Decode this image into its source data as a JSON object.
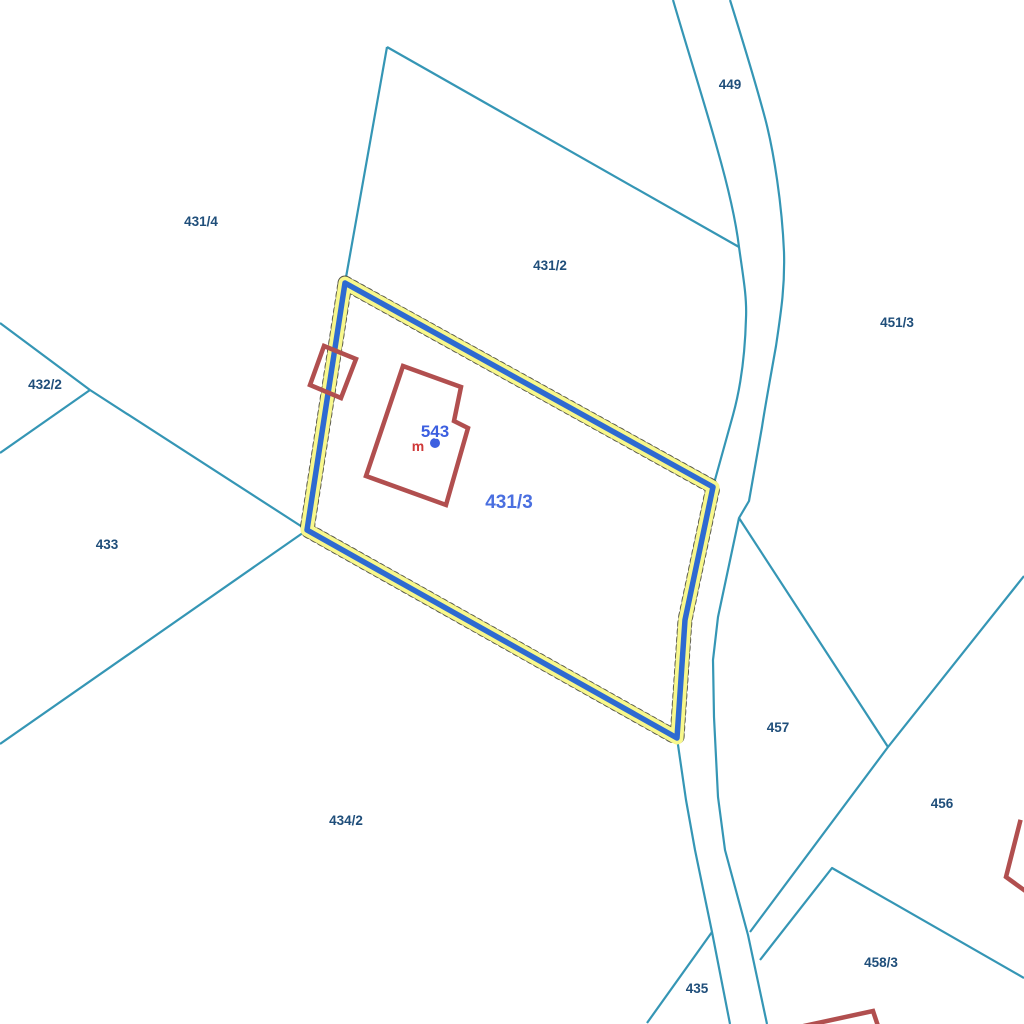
{
  "map": {
    "type": "cadastral-parcel-map",
    "background": "#ffffff",
    "colors": {
      "boundary_line": "#3596b5",
      "parcel_label": "#1f4e7a",
      "building_outline": "#b14f4f",
      "selection_outline": "#2e6ad1",
      "selection_halo": "#f8f88c",
      "point_label": "#3c5fe0",
      "marker_label": "#cf3838"
    },
    "selected_parcel": {
      "number": "431/3"
    },
    "point_of_interest": {
      "number": "543",
      "marker": "m",
      "dot_x": 435,
      "dot_y": 443
    },
    "labels": [
      {
        "text": "449",
        "x": 730,
        "y": 89,
        "kind": "parcel"
      },
      {
        "text": "431/4",
        "x": 201,
        "y": 226,
        "kind": "parcel"
      },
      {
        "text": "431/2",
        "x": 550,
        "y": 270,
        "kind": "parcel"
      },
      {
        "text": "451/3",
        "x": 897,
        "y": 327,
        "kind": "parcel"
      },
      {
        "text": "432/2",
        "x": 45,
        "y": 389,
        "kind": "parcel"
      },
      {
        "text": "433",
        "x": 107,
        "y": 549,
        "kind": "parcel"
      },
      {
        "text": "434/2",
        "x": 346,
        "y": 825,
        "kind": "parcel"
      },
      {
        "text": "457",
        "x": 778,
        "y": 732,
        "kind": "parcel"
      },
      {
        "text": "456",
        "x": 942,
        "y": 808,
        "kind": "parcel"
      },
      {
        "text": "458/3",
        "x": 881,
        "y": 967,
        "kind": "parcel"
      },
      {
        "text": "435",
        "x": 697,
        "y": 993,
        "kind": "parcel"
      },
      {
        "text": "431/3",
        "x": 509,
        "y": 508,
        "kind": "selected"
      },
      {
        "text": "543",
        "x": 435,
        "y": 437,
        "kind": "point"
      },
      {
        "text": "m",
        "x": 418,
        "y": 451,
        "kind": "marker"
      }
    ]
  }
}
